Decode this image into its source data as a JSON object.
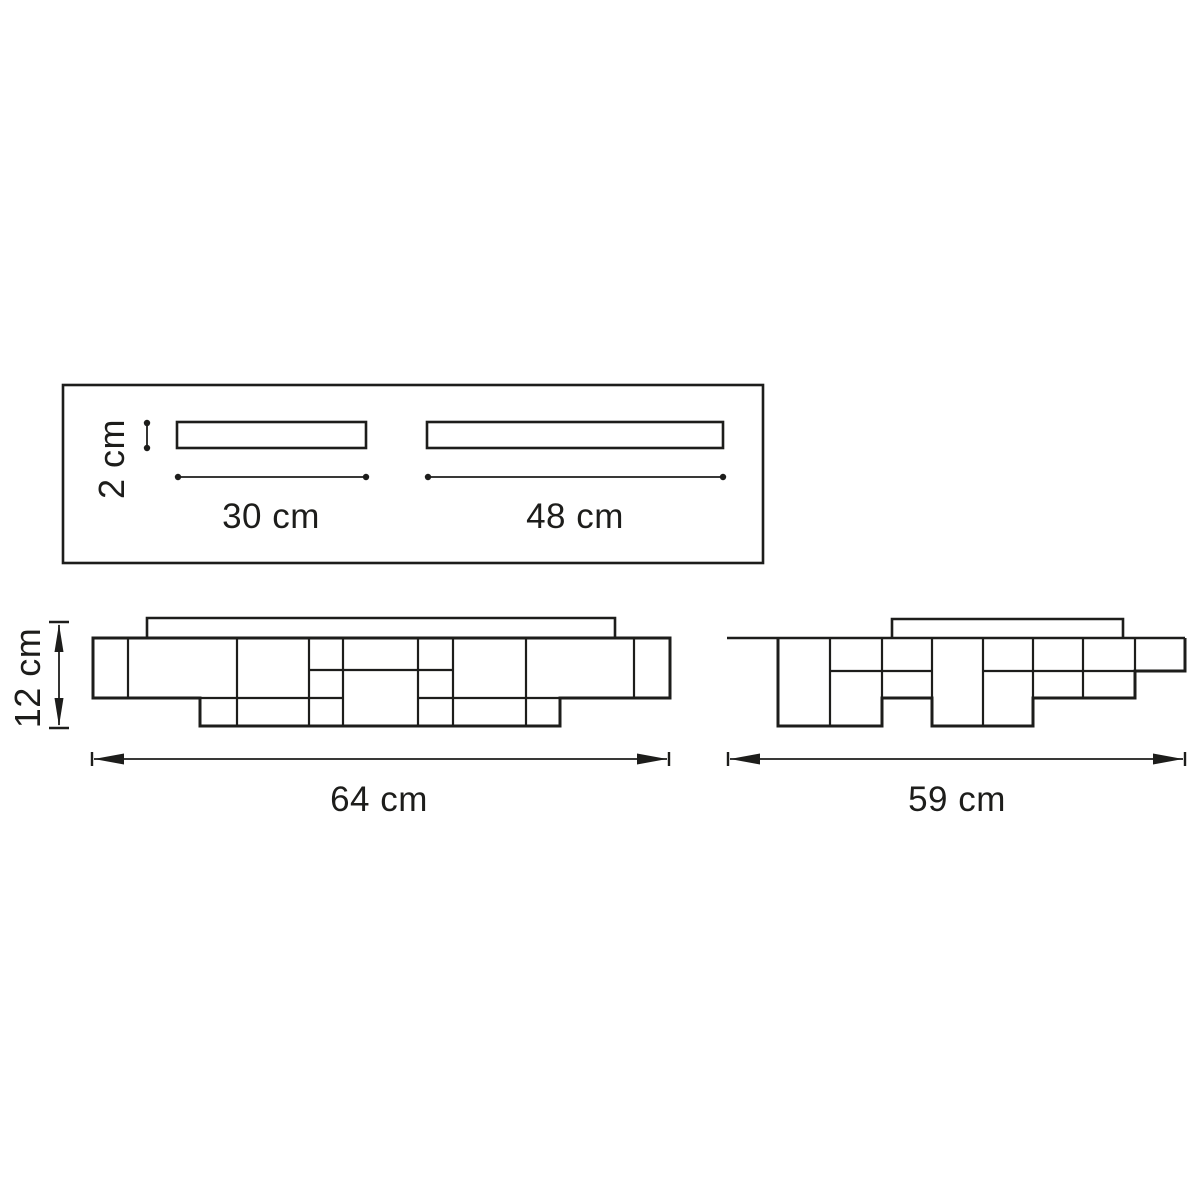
{
  "diagram": {
    "kind": "technical-dimension-drawing",
    "subject": "ceiling lamp — three orthographic views with dimensions",
    "colors": {
      "background": "#ffffff",
      "line": "#1d1d1b"
    },
    "top_view": {
      "slat_thickness_label": "2 cm",
      "slat1_length_label": "30 cm",
      "slat2_length_label": "48 cm"
    },
    "front_view": {
      "height_label": "12 cm",
      "width_label": "64 cm"
    },
    "side_view": {
      "width_label": "59 cm"
    }
  }
}
